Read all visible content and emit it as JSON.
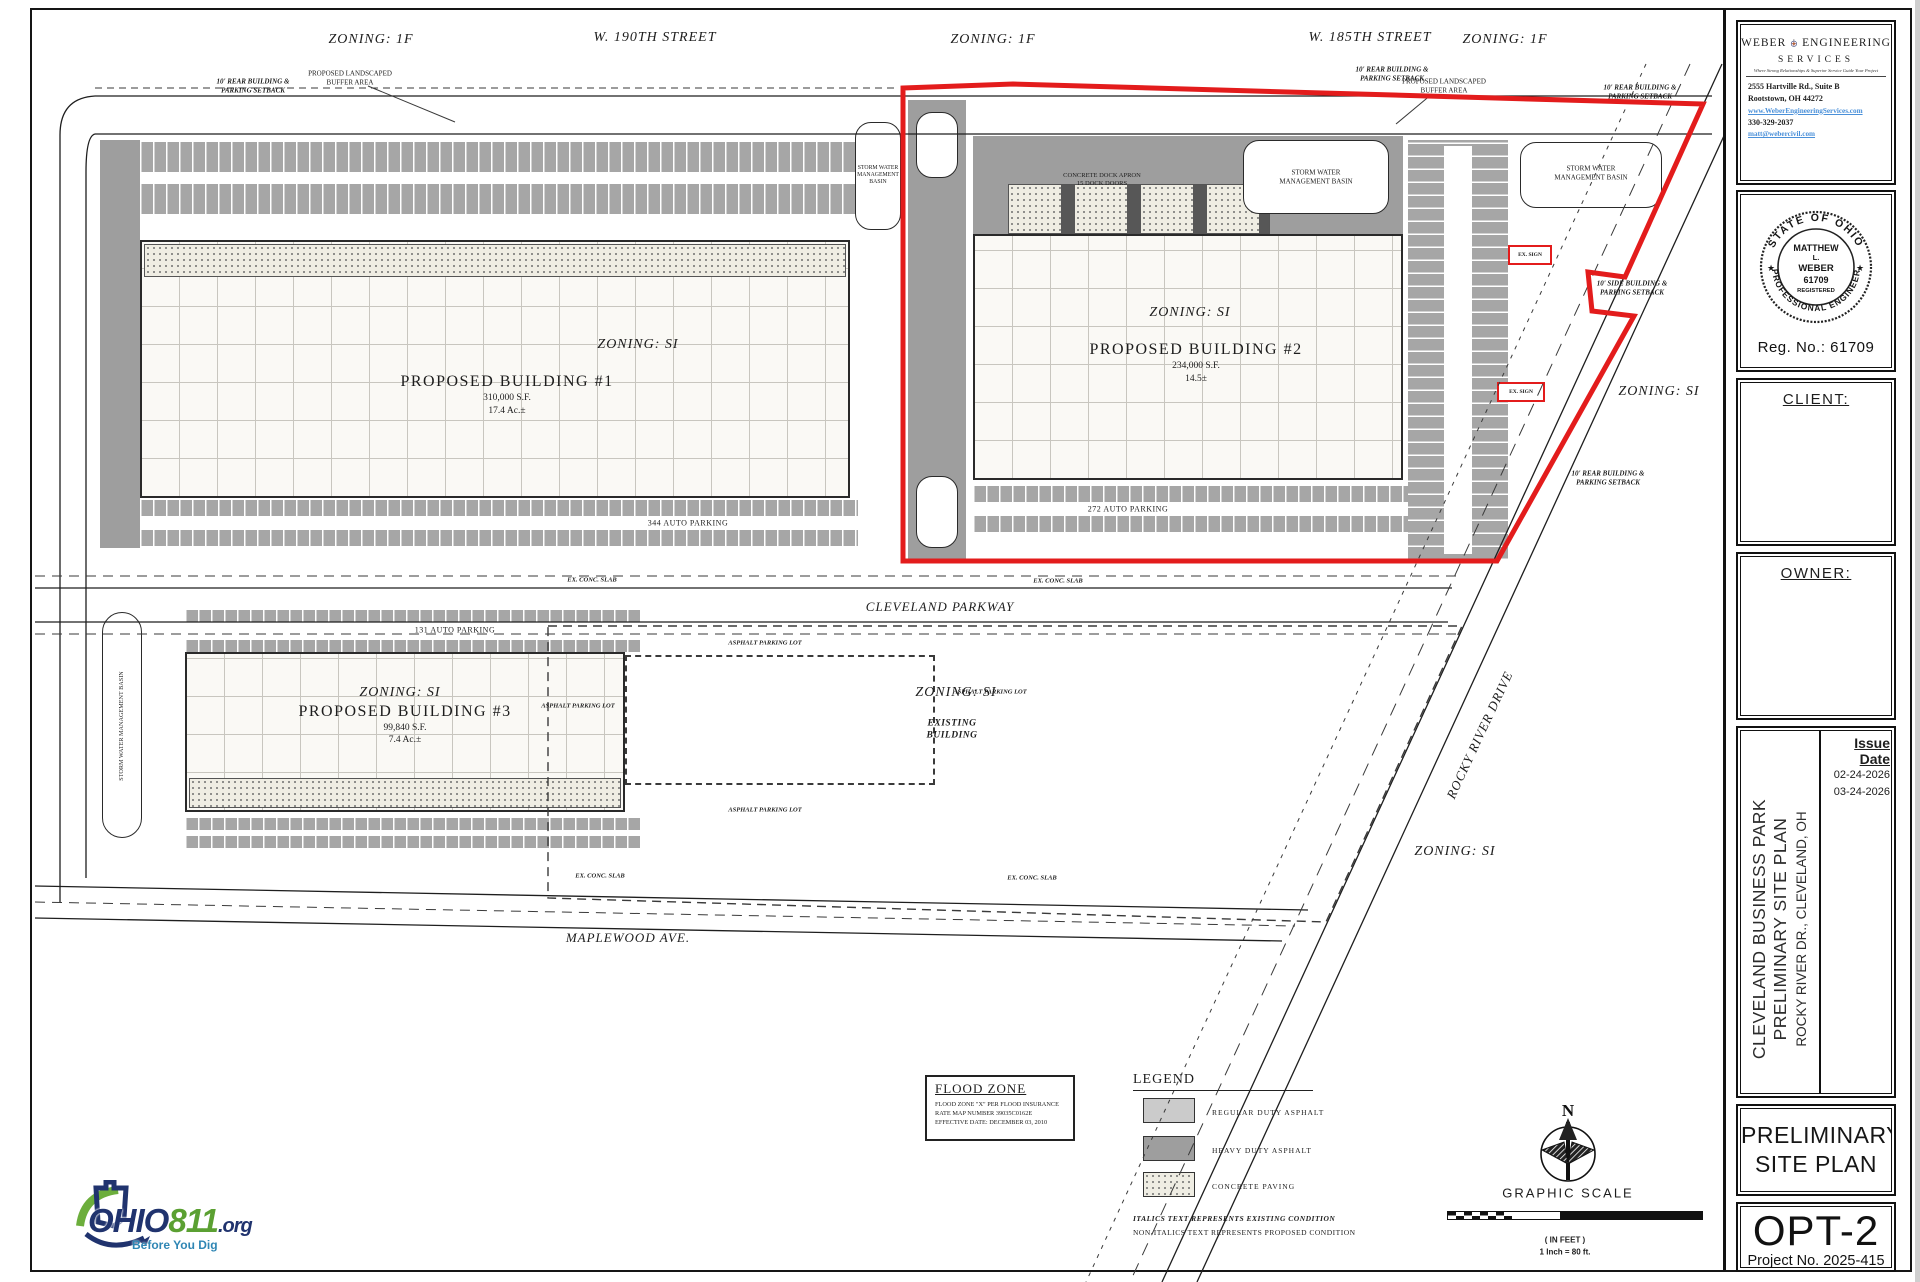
{
  "plan": {
    "streets": {
      "w190": "W. 190TH STREET",
      "w185": "W. 185TH STREET",
      "cleveland": "CLEVELAND PARKWAY",
      "maplewood": "MAPLEWOOD AVE.",
      "rocky": "ROCKY RIVER DRIVE"
    },
    "zoning": {
      "z1f": "ZONING: 1F",
      "zsi": "ZONING: SI"
    },
    "b1": {
      "zoning": "ZONING: SI",
      "name": "PROPOSED BUILDING #1",
      "area": "310,000 S.F.",
      "acres": "17.4 Ac.±"
    },
    "b2": {
      "zoning": "ZONING: SI",
      "name": "PROPOSED BUILDING #2",
      "area": "234,000 S.F.",
      "acres": "14.5±"
    },
    "b3": {
      "zoning": "ZONING: SI",
      "name": "PROPOSED BUILDING #3",
      "area": "99,840 S.F.",
      "acres": "7.4 Ac.±"
    },
    "existing": {
      "zoning": "ZONING: SI",
      "l1": "EXISTING",
      "l2": "BUILDING"
    },
    "labels": {
      "basin_l1": "STORM WATER",
      "basin_l2": "MANAGEMENT",
      "basin_l3": "BASIN",
      "basin_w1": "STORM WATER",
      "basin_w2": "MANAGEMENT BASIN",
      "basin_full": "STORM WATER MANAGEMENT BASIN",
      "buffer_l1": "PROPOSED LANDSCAPED",
      "buffer_l2": "BUFFER AREA",
      "rear_l1": "10' REAR BUILDING &",
      "rear_l2": "PARKING SETBACK",
      "side_l1": "10' SIDE BUILDING &",
      "side_l2": "PARKING SETBACK",
      "apron_l1": "CONCRETE DOCK APRON",
      "apron_l2": "15 DOCK DOORS",
      "p344": "344 AUTO PARKING",
      "p272": "272 AUTO PARKING",
      "p131": "131 AUTO PARKING",
      "asphalt": "ASPHALT PARKING LOT",
      "slab": "EX. CONC. SLAB",
      "sign": "EX. SIGN"
    },
    "flood": {
      "title": "FLOOD ZONE",
      "l1": "FLOOD ZONE \"X\" PER FLOOD INSURANCE",
      "l2": "RATE MAP NUMBER 39035C0162E",
      "l3": "EFFECTIVE DATE: DECEMBER 03, 2010"
    },
    "legend": {
      "title": "LEGEND",
      "items": [
        {
          "label": "REGULAR DUTY ASPHALT"
        },
        {
          "label": "HEAVY DUTY ASPHALT"
        },
        {
          "label": "CONCRETE PAVING"
        }
      ],
      "note1": "ITALICS TEXT REPRESENTS EXISTING CONDITION",
      "note2": "NON-ITALICS TEXT REPRESENTS PROPOSED CONDITION"
    },
    "scalebar": {
      "north": "N",
      "title": "GRAPHIC SCALE",
      "feet": "( IN FEET )",
      "ratio": "1 Inch = 80 ft."
    }
  },
  "titleblock": {
    "firm": {
      "name_left": "WEBER",
      "name_right": "ENGINEERING",
      "name_sub": "SERVICES",
      "tagline": "Where Strong Relationships & Superior Service Guide Your Project",
      "address1": "2555 Hartville Rd., Suite B",
      "address2": "Rootstown, OH 44272",
      "website": "www.WeberEngineeringServices.com",
      "phone": "330-329-2037",
      "email": "matt@webercivil.com"
    },
    "seal": {
      "arc_top": "STATE OF OHIO",
      "arc_bottom": "PROFESSIONAL ENGINEER",
      "c1": "MATTHEW",
      "c2": "L.",
      "c3": "WEBER",
      "c4": "61709",
      "c5": "REGISTERED",
      "star": "★",
      "reg": "Reg. No.:  61709"
    },
    "client_label": "CLIENT:",
    "owner_label": "OWNER:",
    "issue": {
      "label": "Issue Date",
      "d1": "02-24-2026",
      "d2": "03-24-2026"
    },
    "project": {
      "line1": "CLEVELAND BUSINESS PARK",
      "line2": "PRELIMINARY SITE PLAN",
      "line3": "ROCKY RIVER DR.,  CLEVELAND,  OH"
    },
    "sheet_title1": "PRELIMINARY",
    "sheet_title2": "SITE PLAN",
    "option": "OPT-2",
    "project_no": "Project No. 2025-415"
  },
  "logo811": {
    "ohio": "OHIO",
    "num": "811",
    "org": ".org",
    "tagline": "Before You Dig"
  }
}
